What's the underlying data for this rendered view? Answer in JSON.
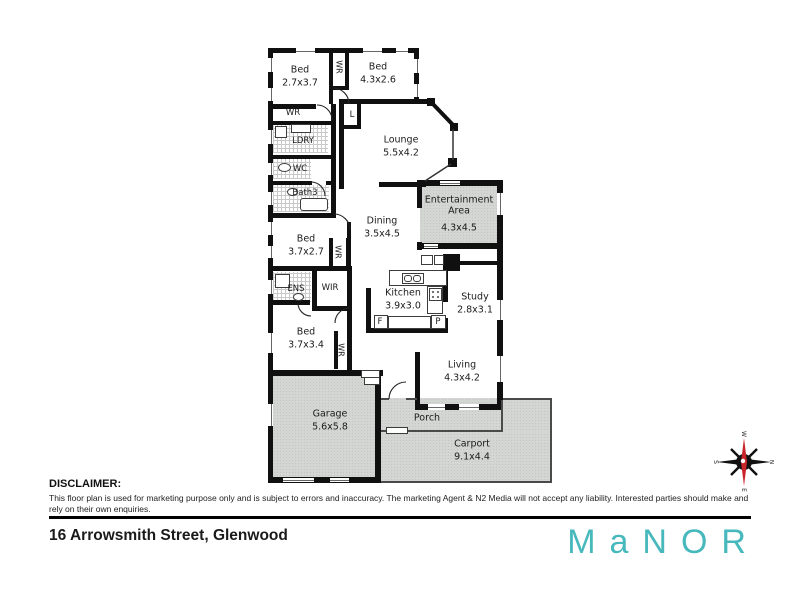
{
  "rooms": {
    "bed_top_left": {
      "name": "Bed",
      "dims": "2.7x3.7"
    },
    "bed_top": {
      "name": "Bed",
      "dims": "4.3x2.6"
    },
    "lounge": {
      "name": "Lounge",
      "dims": "5.5x4.2"
    },
    "dining": {
      "name": "Dining",
      "dims": "3.5x4.5"
    },
    "entertainment": {
      "name": "Entertainment Area",
      "dims": "4.3x4.5"
    },
    "bed_mid": {
      "name": "Bed",
      "dims": "3.7x2.7"
    },
    "kitchen": {
      "name": "Kitchen",
      "dims": "3.9x3.0"
    },
    "study": {
      "name": "Study",
      "dims": "2.8x3.1"
    },
    "bed_lower": {
      "name": "Bed",
      "dims": "3.7x3.4"
    },
    "living": {
      "name": "Living",
      "dims": "4.3x4.2"
    },
    "garage": {
      "name": "Garage",
      "dims": "5.6x5.8"
    },
    "porch": {
      "name": "Porch"
    },
    "carport": {
      "name": "Carport",
      "dims": "9.1x4.4"
    }
  },
  "labels": {
    "wr": "WR",
    "ldry": "LDRY",
    "wc": "WC",
    "bath3": "Bath3",
    "linen": "L",
    "ens": "ENS",
    "wir": "WIR",
    "fridge": "F",
    "pantry": "P"
  },
  "compass": {
    "north": "N",
    "south": "S",
    "east": "E",
    "west": "W"
  },
  "footer": {
    "disclaimer_title": "DISCLAIMER:",
    "disclaimer_text": "This floor plan is used for marketing purpose only and is subject to errors and inaccuracy. The marketing Agent & N2 Media will not accept any liability. Interested parties should make and rely on their own enquiries.",
    "address": "16 Arrowsmith Street, Glenwood",
    "brand": "MaNOR"
  },
  "colors": {
    "brand_teal": "#47b9bd",
    "wall_black": "#101010",
    "area_gray": "#d4d6d3",
    "compass_red": "#c9252b"
  }
}
